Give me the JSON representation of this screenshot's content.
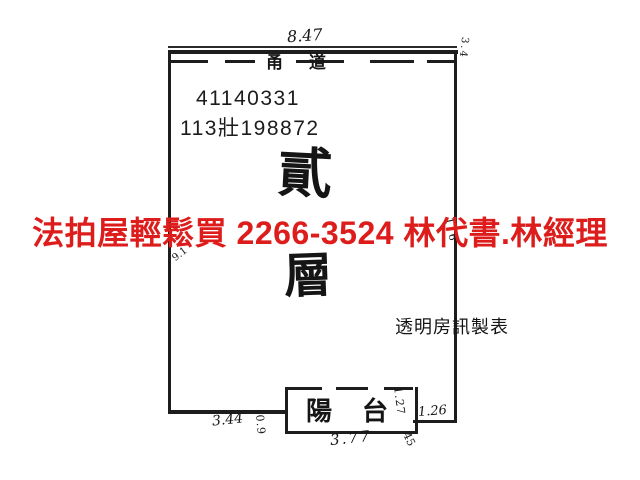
{
  "ad_overlay": {
    "text": "法拍屋輕鬆買  2266-3524  林代書.林經理",
    "color": "#dd1c1c"
  },
  "plan": {
    "top_dimension": "8.47",
    "corridor_label": "甬 道",
    "corner_note": "3.4",
    "registration_number_1": "41140331",
    "registration_number_2": "113壯198872",
    "floor_label": {
      "char_top": "貳",
      "char_bottom": "層",
      "meaning": "second-floor"
    },
    "left_wall_note": "9.1",
    "right_wall_note": "1.6",
    "maker_label": "透明房訊製表",
    "balcony": {
      "label": "陽台",
      "dim_left": "0.9",
      "dim_bottom": "3.77",
      "dim_right": "1.27",
      "dim_corner": "45"
    },
    "dims": {
      "bottom_left": "3.44",
      "bottom_right": "1.26"
    },
    "line_color": "#1d1d1d",
    "background": "#ffffff"
  }
}
